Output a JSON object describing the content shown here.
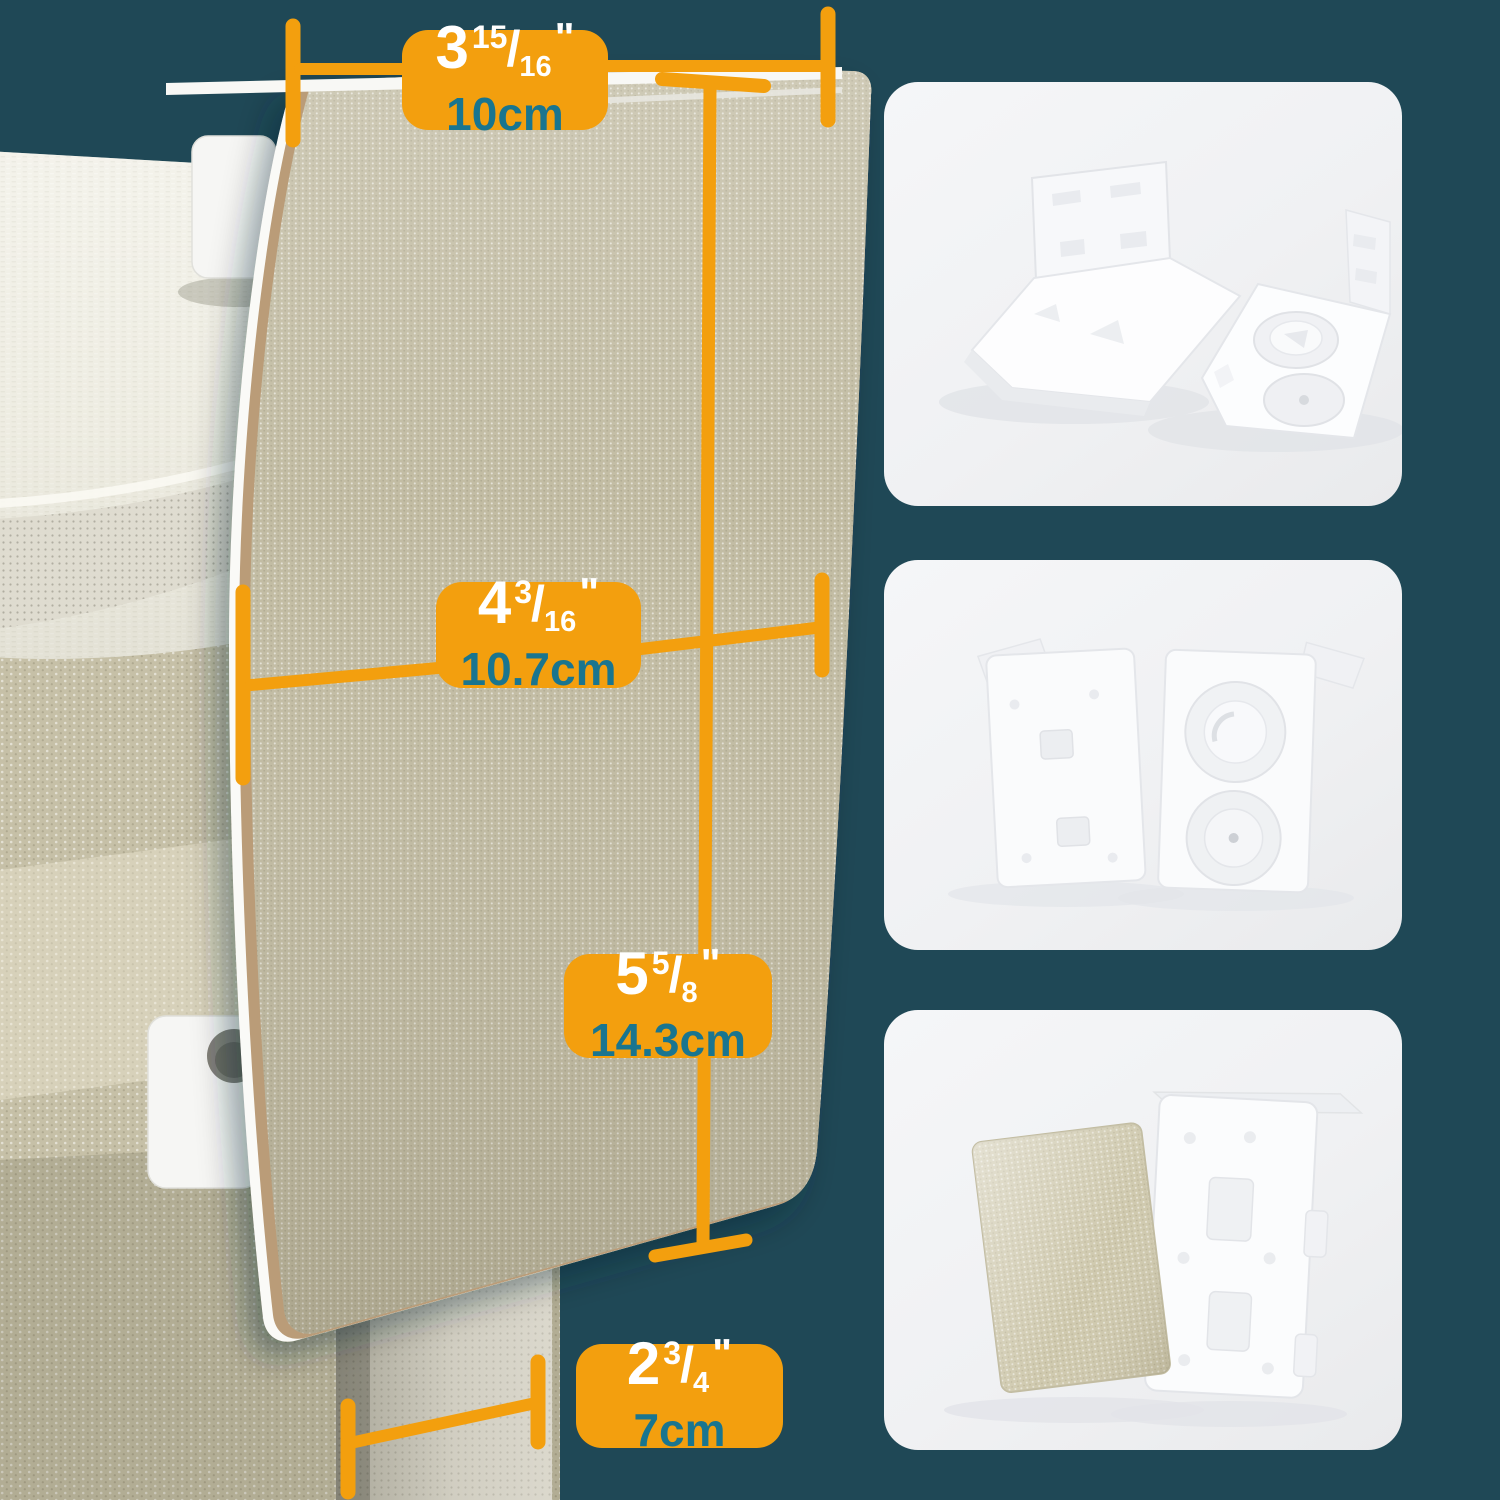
{
  "canvas": {
    "width": 1500,
    "height": 1500
  },
  "colors": {
    "background": "#1F4856",
    "accent_orange": "#F39F0E",
    "inch_text": "#FFFFFF",
    "metric_text": "#19758F",
    "inset_background": "#F2F3F5",
    "panel_fabric": "#C2BCA3",
    "panel_edge_white": "#FAFAF7",
    "panel_edge_tan": "#BA9C78",
    "roll_fabric": "#EFEEE5",
    "back_fabric": "#C6C0A7"
  },
  "symbols": {
    "fraction_slash": "/",
    "inch_mark": "\""
  },
  "dimensions": [
    {
      "name": "top-width",
      "inch_whole": "3",
      "inch_numerator": "15",
      "inch_denominator": "16",
      "metric": "10cm"
    },
    {
      "name": "cover-width",
      "inch_whole": "4",
      "inch_numerator": "3",
      "inch_denominator": "16",
      "metric": "10.7cm"
    },
    {
      "name": "cover-height",
      "inch_whole": "5",
      "inch_numerator": "5",
      "inch_denominator": "8",
      "metric": "14.3cm"
    },
    {
      "name": "cover-depth",
      "inch_whole": "2",
      "inch_numerator": "3",
      "inch_denominator": "4",
      "metric": "7cm"
    }
  ],
  "insets": [
    {
      "name": "bracket-covers-3d-view"
    },
    {
      "name": "bracket-covers-front-back-view"
    },
    {
      "name": "fabric-panel-and-bracket-plate-view"
    }
  ]
}
